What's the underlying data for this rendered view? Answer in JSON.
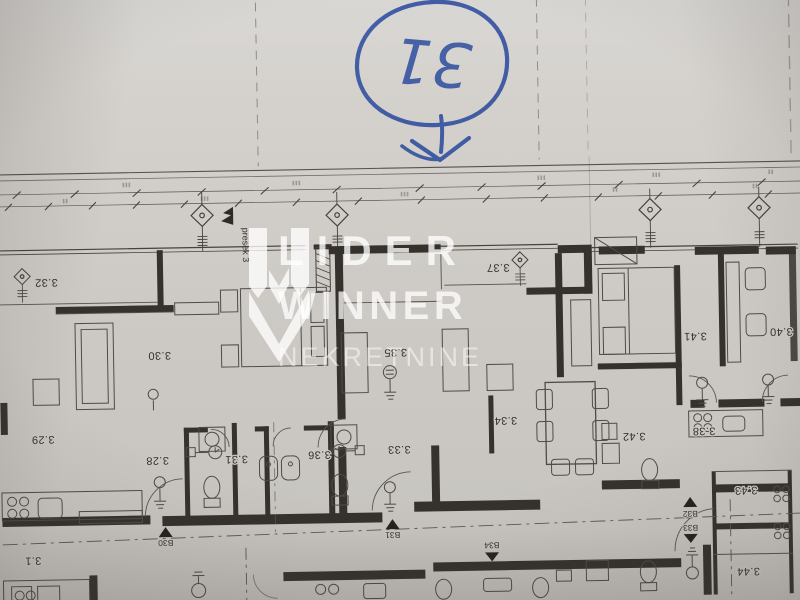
{
  "photo": {
    "paper_color": "#d3d0cb",
    "line_color": "#3e3b37",
    "ink_color": "#2e4d9f"
  },
  "annotation": {
    "circled_number": "31"
  },
  "watermark": {
    "brand_line1": "LIDER",
    "brand_line2": "WINNER",
    "brand_line3": "NEKRETNINE"
  },
  "plan": {
    "section_label": "presek 3",
    "room_labels": [
      {
        "id": "3.32"
      },
      {
        "id": "3.30"
      },
      {
        "id": "3.29"
      },
      {
        "id": "3.28"
      },
      {
        "id": "3.31"
      },
      {
        "id": "3.36"
      },
      {
        "id": "3.33"
      },
      {
        "id": "3.35"
      },
      {
        "id": "3.34"
      },
      {
        "id": "3.37"
      },
      {
        "id": "3.41"
      },
      {
        "id": "3.40"
      },
      {
        "id": "3.42"
      },
      {
        "id": "3.38"
      },
      {
        "id": "3.43"
      },
      {
        "id": "3.44"
      },
      {
        "id": "3.1"
      }
    ],
    "section_markers": [
      {
        "id": "B30"
      },
      {
        "id": "B31"
      },
      {
        "id": "B32"
      },
      {
        "id": "B33"
      },
      {
        "id": "B34"
      }
    ]
  }
}
